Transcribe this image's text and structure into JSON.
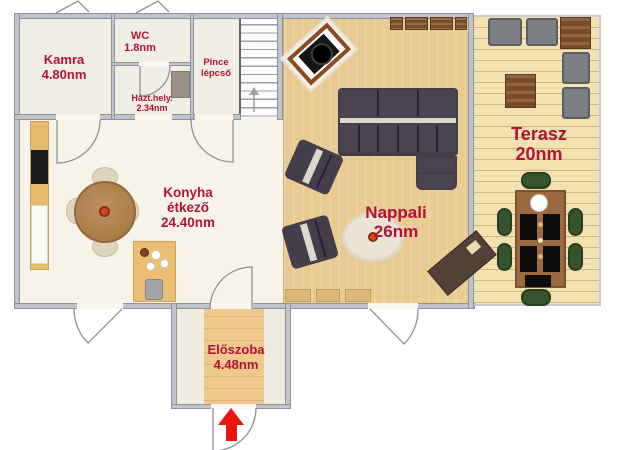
{
  "rooms": {
    "kamra": {
      "name": "Kamra",
      "area": "4.80nm"
    },
    "wc": {
      "name": "WC",
      "area": "1.8nm"
    },
    "pince": {
      "name_line1": "Pince",
      "name_line2": "lépcső"
    },
    "hazthely": {
      "name": "Házt.hely.",
      "area": "2.34nm"
    },
    "konyha": {
      "name_line1": "Konyha",
      "name_line2": "étkező",
      "area": "24.40nm"
    },
    "nappali": {
      "name": "Nappali",
      "area": "26nm"
    },
    "terasz": {
      "name": "Terasz",
      "area": "20nm"
    },
    "eloszoba": {
      "name": "Előszoba",
      "area": "4.48nm"
    }
  },
  "colors": {
    "label_text": "#b31238",
    "wall": "#c0c3cb",
    "wood_floor": "#e9ca90",
    "deck_floor": "#f3e1af",
    "kitchen_floor": "#f8f3e9",
    "utility_floor": "#f1eee3",
    "hall_floor": "#f0ebdf",
    "sofa": "#4a4450",
    "outdoor_cushion": "#7b7e82",
    "furniture_brown": "#7c4a26",
    "dining_chair_green": "#37522f",
    "entrance_arrow": "#e9150f"
  }
}
